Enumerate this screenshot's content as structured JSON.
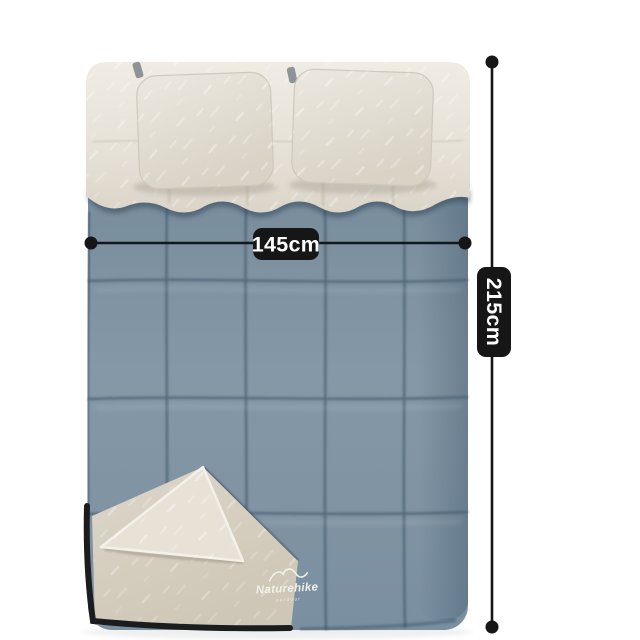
{
  "scene": {
    "description": "double sleeping bag with two pillows and folded-open corner, annotated with size measurements",
    "background_color": "#ffffff"
  },
  "dimensions": {
    "width": {
      "label": "145cm",
      "orientation": "horizontal"
    },
    "height": {
      "label": "215cm",
      "orientation": "vertical"
    },
    "line_color": "#161616",
    "label_background": "#161616",
    "label_text_color": "#ffffff"
  },
  "brand": {
    "name": "Naturehike",
    "tagline": "outdoor",
    "icon": "mountain-logo-icon",
    "text_color": "#f3f0e9"
  },
  "product_colors": {
    "shell_blue": "#7e93a2",
    "shell_seam": "#4a6072",
    "collar_cream": "#e8e3da",
    "pillow_cream": "#e5e0d7",
    "lining_beige": "#d8d1c4",
    "zipper_trim": "#1b1c1e"
  }
}
